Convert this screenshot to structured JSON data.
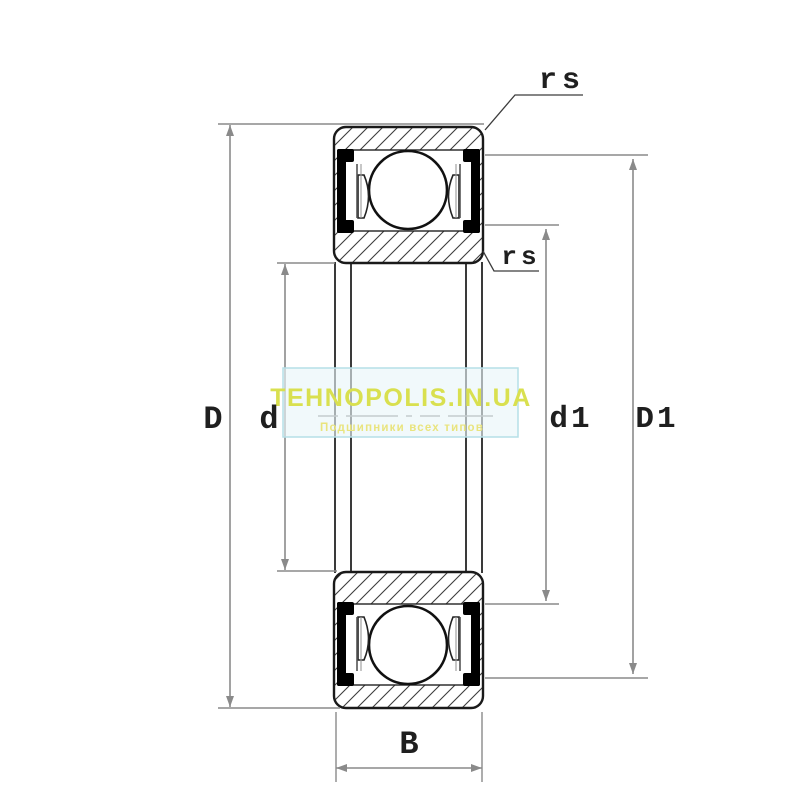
{
  "drawing": {
    "type": "bearing-cross-section",
    "description": "Sealed deep groove ball bearing 2RS technical drawing"
  },
  "dimensions": {
    "outer_diameter": "D",
    "bore_diameter": "d",
    "inner_seal_diameter": "d1",
    "outer_seal_diameter": "D1",
    "width": "B",
    "corner_radius": "rs"
  },
  "watermark": {
    "title": "TEHNOPOLIS.IN.UA",
    "subtitle": "Подшипники всех типов",
    "title_color": "#d9e04f",
    "subtitle_color": "#e9e47e",
    "band_fill": "#e8f5f9",
    "band_border": "#b5dfe7"
  },
  "colors": {
    "drawing_line": "#1a1a1a",
    "dimension_line": "#8a8a8a",
    "seal": "#000000",
    "background": "#ffffff"
  }
}
